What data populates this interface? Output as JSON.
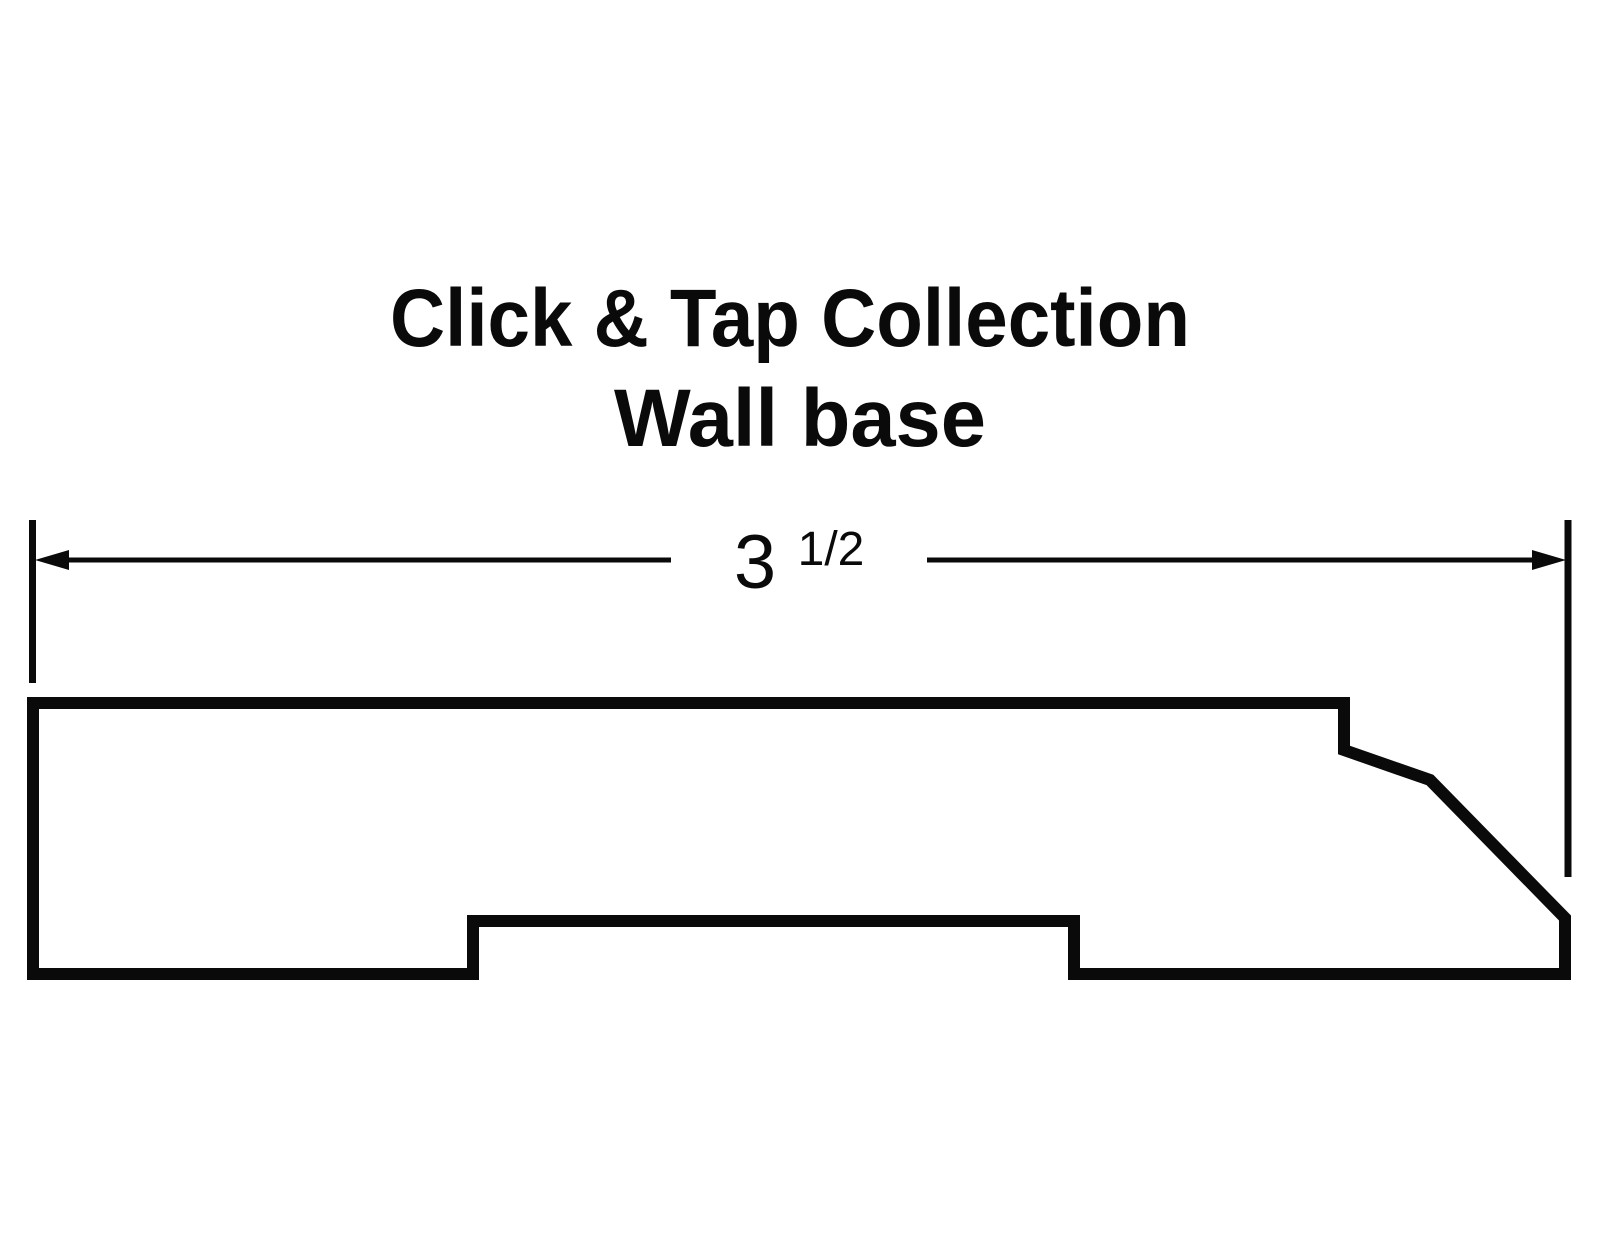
{
  "colors": {
    "background": "#ffffff",
    "ink": "#0a0a0a"
  },
  "title": {
    "line1": "Click & Tap Collection",
    "line2": "Wall base"
  },
  "dimension": {
    "whole": "3",
    "fraction": "1/2",
    "full_label": "3 1/2"
  }
}
